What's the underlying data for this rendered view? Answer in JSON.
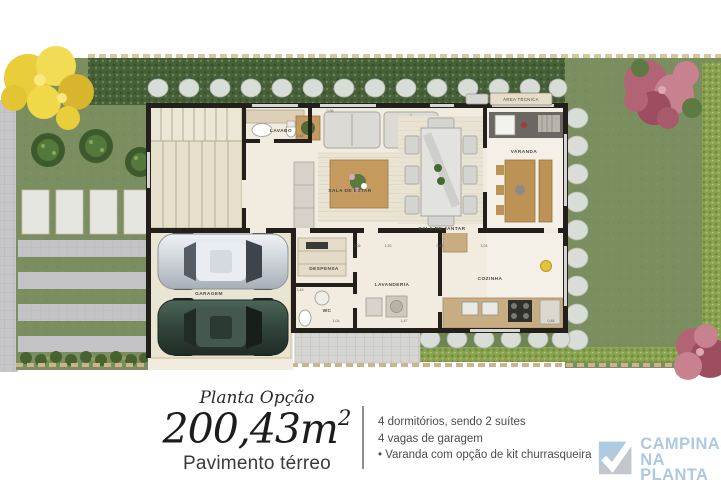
{
  "plan": {
    "labels": {
      "lavabo": "LAVABO",
      "sala_de_estar": "SALA DE ESTAR",
      "sala_de_jantar": "SALA DE JANTAR",
      "varanda": "VARANDA",
      "area_tecnica": "ÁREA TÉCNICA",
      "despensa": "DESPENSA",
      "wc": "WC",
      "lavanderia": "LAVANDERIA",
      "cozinha": "COZINHA",
      "garagem": "GARAGEM"
    },
    "measurements": [
      "1,42",
      "2,06",
      "1,92",
      "0,61",
      "1,44",
      "1,04",
      "1,47",
      "3,04",
      "0,84",
      "0,36"
    ]
  },
  "info": {
    "plan_option": "Planta Opção",
    "area": "200,43m",
    "area_sup": "2",
    "floor": "Pavimento térreo",
    "features": [
      "4 dormitórios, sendo 2 suítes",
      "4 vagas de garagem",
      "• Varanda com opção de kit churrasqueira"
    ]
  },
  "logo": {
    "name_line1": "CAMPINAS",
    "name_line2": "NA PLANTA",
    "creci": "CRECI 29.707-J"
  },
  "colors": {
    "lawn": "#7b8e5f",
    "hedge_dark": "#46603a",
    "hedge_light": "#88a24f",
    "floor": "#f1ecdf",
    "wall": "#23201c",
    "wood": "#c49a5e",
    "paving": "#c6c6ca",
    "fence": "#cdb488",
    "logo_blue": "#adc9e1",
    "logo_gray": "#c3c7cb"
  }
}
